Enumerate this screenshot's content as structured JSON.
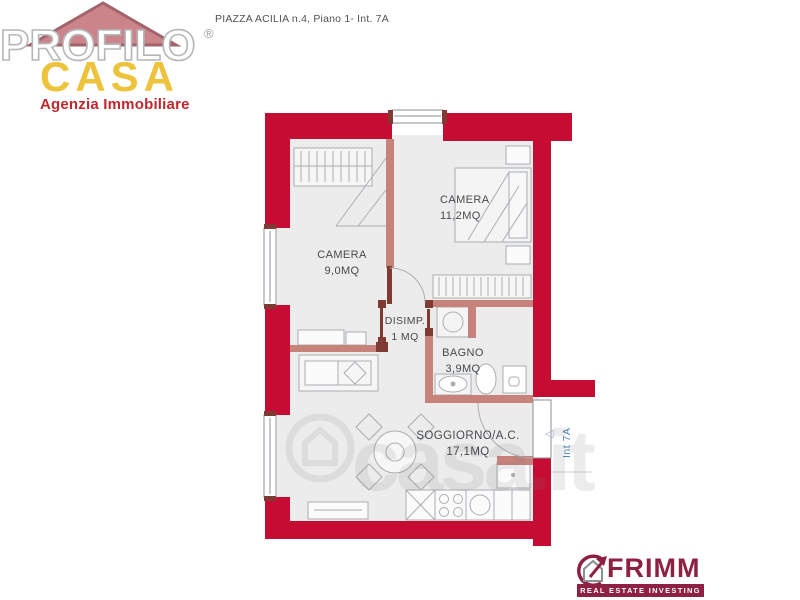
{
  "header": {
    "address": "PIAZZA ACILIA n.4, Piano 1- Int. 7A"
  },
  "agency_logo": {
    "name_line1": "PROFILO",
    "registered_mark": "®",
    "name_line2": "CASA",
    "tagline": "Agenzia Immobiliare"
  },
  "floor_plan": {
    "rooms": [
      {
        "name": "CAMERA",
        "area": "11,2MQ"
      },
      {
        "name": "CAMERA",
        "area": "9,0MQ"
      },
      {
        "name": "DISIMP.",
        "area": "1 MQ"
      },
      {
        "name": "BAGNO",
        "area": "3,9MQ"
      },
      {
        "name": "SOGGIORNO/A.C.",
        "area": "17,1MQ"
      }
    ],
    "entrance_label": "Int 7A",
    "entrance_arrow": "◁"
  },
  "watermark": {
    "text": "casa.it"
  },
  "footer_logo": {
    "brand": "FRIMM",
    "tagline": "REAL ESTATE INVESTING"
  },
  "colors": {
    "wall_red": "#c60c33",
    "partition_salmon": "#c7837b",
    "door_post_dark": "#7e3a33",
    "room_fill": "#ececed",
    "furniture_stroke": "#a9aeb2",
    "casa_yellow": "#edc33c",
    "agency_red": "#c0272d",
    "frimm_maroon": "#8e2142",
    "entrance_blue": "#4a7fb5"
  }
}
